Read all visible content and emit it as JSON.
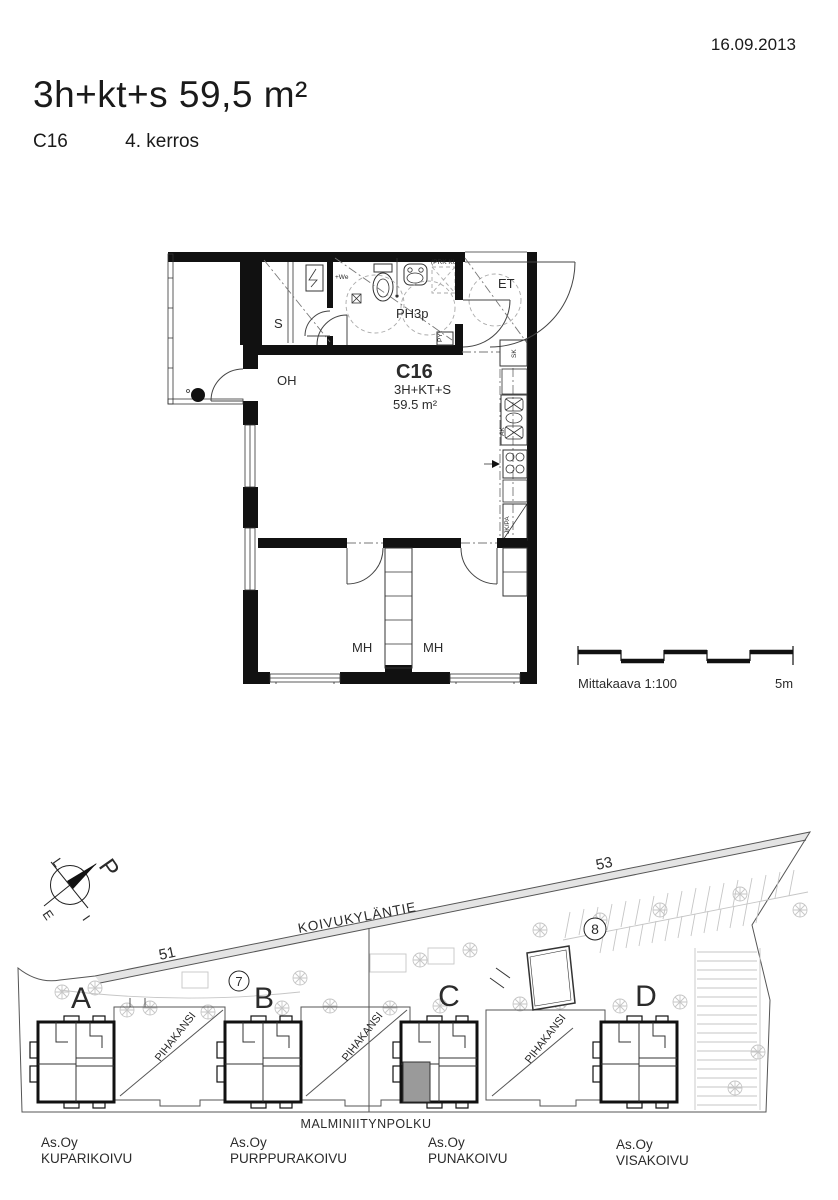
{
  "header": {
    "date": "16.09.2013",
    "title": "3h+kt+s  59,5 m²",
    "unit_id": "C16",
    "floor": "4. kerros"
  },
  "floor_plan": {
    "unit": {
      "id": "C16",
      "type": "3H+KT+S",
      "area": "59.5  m²"
    },
    "rooms": {
      "sauna": "S",
      "living_room": "OH",
      "bathroom": "PH3p",
      "entry": "ET",
      "bedroom": "MH"
    },
    "fixtures": {
      "laundry": "PY",
      "cleaning_closet": "SK",
      "dishwasher": "AK",
      "fridge_freezer": "JK/PA",
      "shower": "+We",
      "washer_reservation": "(PRK KU)"
    },
    "scale": {
      "label": "Mittakaava 1:100",
      "max": "5m"
    }
  },
  "site_plan": {
    "street_name": "KOIVUKYLÄNTIE",
    "path_name": "MALMINIITYNPOLKU",
    "plot_numbers": {
      "left": "51",
      "right": "53"
    },
    "building_numbers": {
      "left": "7",
      "right": "8"
    },
    "compass": {
      "north": "P",
      "west": "L",
      "south": "E",
      "east": "I"
    },
    "deck_label": "PIHAKANSI",
    "highlight_color": "#9a9a9a",
    "buildings": [
      {
        "letter": "A",
        "company": "As.Oy",
        "name": "KUPARIKOIVU"
      },
      {
        "letter": "B",
        "company": "As.Oy",
        "name": "PURPPURAKOIVU"
      },
      {
        "letter": "C",
        "company": "As.Oy",
        "name": "PUNAKOIVU",
        "highlighted": true
      },
      {
        "letter": "D",
        "company": "As.Oy",
        "name": "VISAKOIVU"
      }
    ]
  }
}
